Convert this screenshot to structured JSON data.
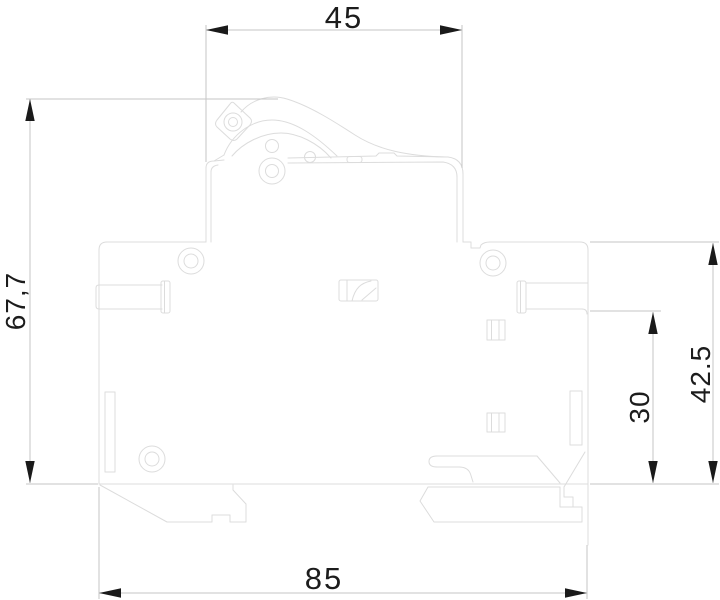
{
  "drawing": {
    "kind": "technical-dimension-drawing",
    "subject": "circuit-breaker side profile with DIN-rail mount",
    "dimensions": {
      "top_width": {
        "label": "45",
        "value": 45,
        "orientation": "horizontal",
        "location": "top"
      },
      "overall_height": {
        "label": "67,7",
        "value": 67.7,
        "orientation": "vertical",
        "location": "left"
      },
      "body_height": {
        "label": "42.5",
        "value": 42.5,
        "orientation": "vertical",
        "location": "right-outer"
      },
      "mount_height": {
        "label": "30",
        "value": 30,
        "orientation": "vertical",
        "location": "right-inner"
      },
      "overall_width": {
        "label": "85",
        "value": 85,
        "orientation": "horizontal",
        "location": "bottom"
      }
    },
    "colors": {
      "background_color": "#ffffff",
      "outline_color": "#dcdcdc",
      "dimension_line_color": "#c6c6c6",
      "arrow_color": "#1a1a1a",
      "dimension_text_color": "#1c1c1c"
    }
  }
}
